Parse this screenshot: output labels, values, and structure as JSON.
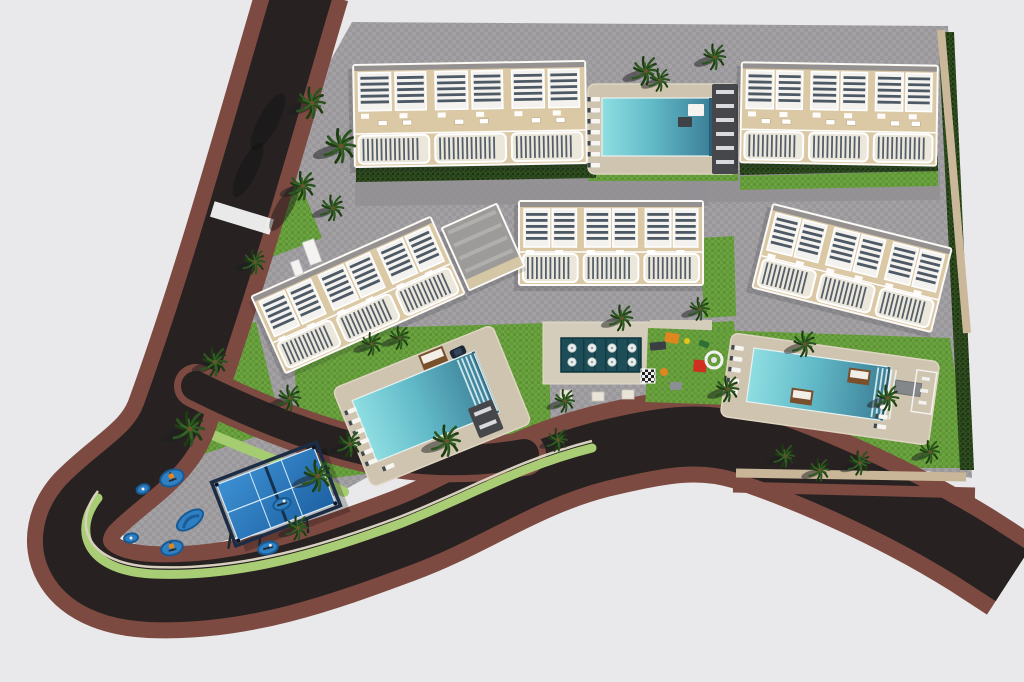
{
  "meta": {
    "title": "aerial-3d-site-plan-residential-complex",
    "view": "top-down aerial render",
    "visible_text": ""
  },
  "palette": {
    "background": "#e9e9eb",
    "asphalt": "#272221",
    "sidewalk": "#7d4a41",
    "paving": "#a3a1a4",
    "street_gray": "#929093",
    "lawn": "#6ba43f",
    "hedge": "#2e4b1f",
    "building_beige": "#dbc9a6",
    "building_white": "#fbfaf7",
    "louver": "#4d5965",
    "deck_beige": "#cfc4af",
    "spa_teal": "#1d4d57",
    "pool_light": "#8edee2",
    "pool_deep": "#3b7e97",
    "padel_blue": "#2f86c8",
    "pad_blue": "#2f80c3",
    "cabana_brown": "#7a4f2c",
    "accent_orange": "#e0861f",
    "accent_red": "#cf3020",
    "accent_yellow": "#e6c11c",
    "wall_tan": "#cbb89a",
    "palm_green": "#2b5420",
    "palm_dark": "#1e3c13"
  },
  "scene": {
    "w": 1024,
    "h": 682,
    "site_polygon": "352,22 948,26 972,478 740,442 640,436 560,442 500,452 430,458 380,470 330,498 260,530 160,560 100,520 140,430 175,412 300,115",
    "entry_stub": "298,140 356,118 356,212 288,206",
    "mid_band": "355,174 940,168 940,200 355,206",
    "cross_band": "681,170 709,170 709,206 681,206",
    "roads": {
      "main": "M304,-12 C272,95 224,272 172,415 C158,455 120,472 88,505 C58,538 70,588 150,592 C240,596 322,566 400,537 C468,512 520,472 598,452 C660,437 700,430 745,444 C812,466 902,506 975,552 L1012,576",
      "inner": "M196,386 C256,416 330,446 396,456 C442,463 484,461 524,454",
      "curb_green": "M98,498 C74,528 82,570 152,574 C240,578 324,552 402,523 C468,497 520,466 592,448",
      "light_band": "M196,428 C252,452 300,468 344,492"
    },
    "crosswalk": {
      "x": 242,
      "y": 218,
      "w": 62,
      "h": 16,
      "rot": 17
    },
    "walls": [
      [
        941,
        30,
        967,
        333,
        "#cbb89a",
        8
      ],
      [
        736,
        473,
        966,
        477,
        "#c9b698",
        9
      ],
      [
        733,
        487,
        975,
        493,
        "#7d4a41",
        11
      ]
    ],
    "lawns": [
      {
        "id": "lawn-north-pool",
        "points": "588,168 738,168 738,181 588,181"
      },
      {
        "id": "lawn-north-east",
        "points": "740,176 938,171 938,186 740,190"
      },
      {
        "id": "lawn-west-pool",
        "points": "292,330 548,323 552,470 455,478 380,472 302,482"
      },
      {
        "id": "lawn-amenity",
        "points": "645,326 734,321 740,404 652,406"
      },
      {
        "id": "lawn-east-pool",
        "points": "712,330 950,338 968,468 735,468 718,420"
      },
      {
        "id": "lawn-entry",
        "points": "228,188 300,182 322,238 248,266"
      },
      {
        "id": "lawn-mid-left",
        "points": "158,334 256,322 282,428 192,458"
      },
      {
        "id": "lawn-center-right",
        "points": "700,238 734,236 736,316 704,318"
      }
    ],
    "hedges": [
      {
        "id": "hedge-row1",
        "points": "356,168 596,164 596,178 356,182"
      },
      {
        "id": "hedge-row2",
        "points": "740,160 938,156 938,171 740,175"
      },
      {
        "id": "hedge-east-boundary",
        "points": "938,32 954,32 974,470 960,470"
      }
    ],
    "buildings": [
      {
        "id": "block-1",
        "cx": 470,
        "cy": 114,
        "w": 234,
        "h": 104,
        "rot": -1,
        "modules": 3
      },
      {
        "id": "block-2",
        "cx": 839,
        "cy": 114,
        "w": 198,
        "h": 102,
        "rot": 1,
        "modules": 3
      },
      {
        "id": "block-3",
        "cx": 358,
        "cy": 295,
        "w": 198,
        "h": 86,
        "rot": -24,
        "modules": 3
      },
      {
        "id": "block-4",
        "cx": 611,
        "cy": 243,
        "w": 186,
        "h": 86,
        "rot": 0,
        "modules": 3
      },
      {
        "id": "block-5",
        "cx": 852,
        "cy": 268,
        "w": 186,
        "h": 88,
        "rot": 14,
        "modules": 3
      }
    ],
    "clubhouse": {
      "cx": 483,
      "cy": 247,
      "w": 62,
      "h": 70,
      "rot": -24
    },
    "pools": [
      {
        "id": "pool-north",
        "cx": 663,
        "cy": 129,
        "rot": 0,
        "deck_w": 150,
        "deck_h": 90,
        "water_w": 110,
        "water_h": 58,
        "water_dx": -6,
        "water_dy": -2,
        "steps_x": null,
        "loungers": [
          [
            -72,
            -32
          ],
          [
            -72,
            -21
          ],
          [
            -72,
            -10
          ],
          [
            -72,
            1
          ],
          [
            -72,
            12
          ],
          [
            -72,
            23
          ],
          [
            -72,
            34
          ]
        ],
        "pavilion": [
          49,
          -45,
          26,
          90
        ],
        "beds": [
          [
            25,
            -25,
            16,
            12,
            "#f5f3ef"
          ],
          [
            15,
            -12,
            14,
            10,
            "#3c4246"
          ]
        ]
      },
      {
        "id": "pool-west",
        "cx": 432,
        "cy": 406,
        "rot": -22,
        "deck_w": 172,
        "deck_h": 106,
        "water_w": 132,
        "water_h": 66,
        "water_dx": -6,
        "water_dy": -2,
        "steps_x": 40,
        "loungers": [
          [
            -80,
            -28
          ],
          [
            -80,
            -17
          ],
          [
            -80,
            -6
          ],
          [
            -80,
            5
          ],
          [
            -80,
            16
          ],
          [
            -80,
            27
          ],
          [
            -66,
            38
          ]
        ],
        "cabanas": [
          [
            6,
            -52,
            26,
            16
          ]
        ],
        "pavilion": [
          32,
          16,
          26,
          32
        ]
      },
      {
        "id": "pool-east",
        "cx": 830,
        "cy": 389,
        "rot": 8,
        "deck_w": 210,
        "deck_h": 84,
        "water_w": 138,
        "water_h": 54,
        "water_dx": -12,
        "water_dy": -3,
        "steps_x": 44,
        "loungers": [
          [
            -100,
            -30
          ],
          [
            -100,
            -19
          ],
          [
            -100,
            -8
          ],
          [
            -100,
            3
          ],
          [
            -100,
            14
          ],
          [
            52,
            8
          ],
          [
            52,
            18
          ],
          [
            52,
            28
          ]
        ],
        "cabanas": [
          [
            -38,
            4,
            22,
            15
          ],
          [
            16,
            -24,
            22,
            15
          ]
        ],
        "pergola": [
          64,
          -18,
          26,
          13
        ]
      }
    ],
    "east_fence": {
      "x": 924,
      "y": 392,
      "w": 20,
      "h": 42,
      "rot": 8
    },
    "spa": {
      "deck": [
        543,
        322,
        112,
        62
      ],
      "arm": [
        650,
        320,
        62,
        28
      ],
      "teal": [
        561,
        338,
        80,
        34
      ],
      "circle_cols": [
        572,
        592,
        612,
        632
      ],
      "circle_rows": [
        348,
        362
      ],
      "circle_r": 4.2,
      "pads": [
        [
          560,
          390
        ],
        [
          592,
          392
        ],
        [
          622,
          390
        ]
      ]
    },
    "playground": {
      "lawn": [
        648,
        328,
        86,
        74
      ],
      "items": [
        {
          "x": 672,
          "y": 338,
          "w": 14,
          "h": 10,
          "rot": 10,
          "c": "#e0861f"
        },
        {
          "x": 658,
          "y": 346,
          "w": 16,
          "h": 8,
          "rot": -5,
          "c": "#3a3f44"
        },
        {
          "x": 700,
          "y": 366,
          "w": 13,
          "h": 12,
          "rot": 5,
          "c": "#cf3020"
        },
        {
          "x": 704,
          "y": 344,
          "w": 10,
          "h": 6,
          "rot": 20,
          "c": "#2f6e35"
        },
        {
          "x": 676,
          "y": 386,
          "w": 12,
          "h": 8,
          "rot": 0,
          "c": "#8a8f93"
        }
      ],
      "dots": [
        {
          "x": 687,
          "y": 341,
          "r": 3,
          "c": "#e6c11c"
        },
        {
          "x": 664,
          "y": 372,
          "r": 4,
          "c": "#e0861f"
        }
      ],
      "slide": {
        "x": 714,
        "y": 360,
        "r": 8
      },
      "checker": [
        641,
        369,
        14,
        14
      ]
    },
    "padel": {
      "cx": 276,
      "cy": 494,
      "rot": -21,
      "ow": 112,
      "oh": 68,
      "iw": 104,
      "ih": 60
    },
    "gym_pads": [
      [
        172,
        478,
        24,
        16,
        -20,
        "tower"
      ],
      [
        143,
        489,
        13,
        9,
        -20,
        "dot"
      ],
      [
        190,
        520,
        30,
        15,
        -35,
        "path"
      ],
      [
        131,
        538,
        14,
        9,
        -10,
        "dot"
      ],
      [
        172,
        548,
        22,
        14,
        -15,
        "tower"
      ],
      [
        282,
        504,
        18,
        11,
        -20,
        "bar"
      ],
      [
        268,
        548,
        20,
        12,
        -15,
        "bar"
      ]
    ],
    "palms": [
      [
        312,
        103,
        1.1
      ],
      [
        341,
        146,
        1.2
      ],
      [
        303,
        186,
        1.0
      ],
      [
        333,
        208,
        0.9
      ],
      [
        255,
        262,
        0.85
      ],
      [
        215,
        362,
        1.0
      ],
      [
        290,
        398,
        0.9
      ],
      [
        400,
        338,
        0.8
      ],
      [
        372,
        344,
        0.8
      ],
      [
        350,
        444,
        0.9
      ],
      [
        447,
        441,
        1.1
      ],
      [
        558,
        440,
        0.8
      ],
      [
        190,
        429,
        1.2
      ],
      [
        318,
        476,
        1.1
      ],
      [
        298,
        528,
        0.85
      ],
      [
        565,
        401,
        0.8
      ],
      [
        622,
        318,
        0.9
      ],
      [
        700,
        309,
        0.8
      ],
      [
        728,
        389,
        0.9
      ],
      [
        805,
        344,
        0.9
      ],
      [
        888,
        398,
        0.9
      ],
      [
        860,
        463,
        0.85
      ],
      [
        785,
        456,
        0.8
      ],
      [
        930,
        452,
        0.8
      ],
      [
        820,
        470,
        0.8
      ],
      [
        715,
        57,
        0.9
      ],
      [
        646,
        71,
        1.0
      ],
      [
        660,
        80,
        0.8
      ]
    ],
    "extra_shadows": [
      [
        268,
        122,
        32,
        10,
        -62
      ],
      [
        248,
        170,
        30,
        9,
        -64
      ],
      [
        284,
        208,
        26,
        8,
        -60
      ],
      [
        650,
        112,
        30,
        9,
        -12
      ]
    ],
    "car": {
      "x": 458,
      "y": 352,
      "rot": -25
    },
    "gates": [
      [
        312,
        252,
        12,
        24,
        -20
      ],
      [
        297,
        268,
        9,
        15,
        -20
      ]
    ]
  }
}
